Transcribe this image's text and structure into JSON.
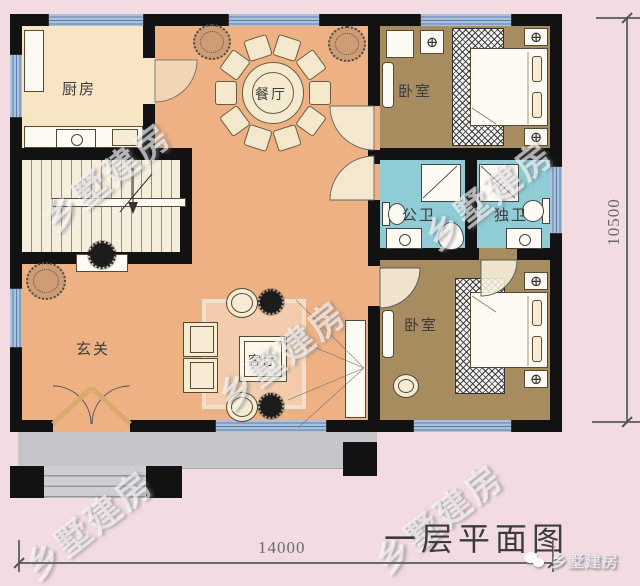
{
  "caption": {
    "title": "一层平面图"
  },
  "dimensions": {
    "bottom": "14000",
    "right": "10500"
  },
  "watermark": {
    "text": "乡墅建房"
  },
  "brand": {
    "name": "乡墅建房"
  },
  "rooms": {
    "kitchen": "厨房",
    "dining": "餐厅",
    "bedroom_top": "卧室",
    "bath_shared": "公卫",
    "bath_ensuite": "独卫",
    "entry": "玄关",
    "living": "客厅",
    "bedroom_bottom": "卧室"
  },
  "colors": {
    "background": "#f3dce1",
    "wall": "#121212",
    "floor_hall": "#edb184",
    "floor_kitchen": "#f8e5c4",
    "floor_bedroom": "#a78c60",
    "floor_bath": "#8fccd5",
    "window": "#a9c2de",
    "porch": "#c6c6ca"
  }
}
